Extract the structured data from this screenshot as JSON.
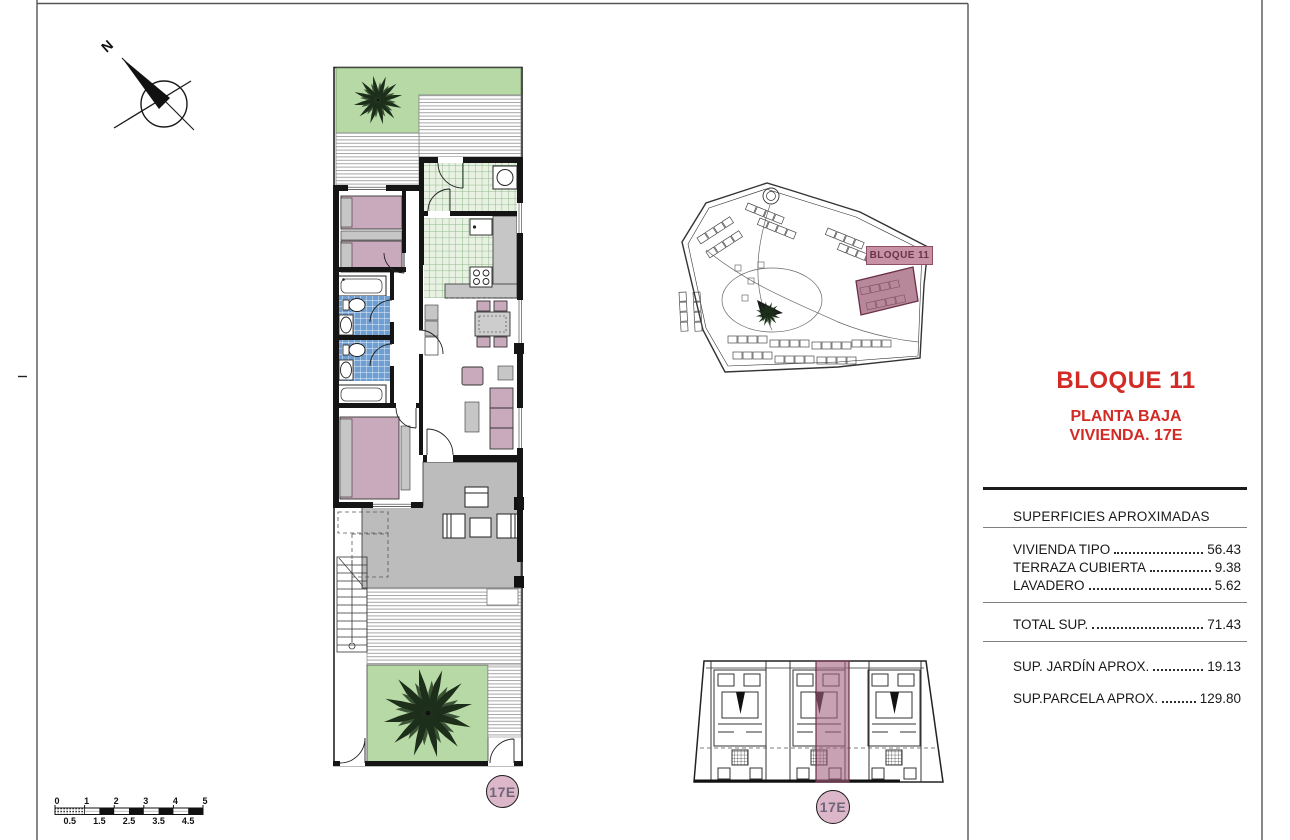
{
  "compass": {
    "label": "N"
  },
  "title_block": {
    "bloque": "BLOQUE 11",
    "planta": "PLANTA BAJA",
    "vivienda": "VIVIENDA. 17E"
  },
  "areas_table": {
    "header": "SUPERFICIES APROXIMADAS",
    "rows": [
      {
        "label": "VIVIENDA TIPO",
        "value": "56.43"
      },
      {
        "label": "TERRAZA CUBIERTA",
        "value": "9.38"
      },
      {
        "label": "LAVADERO",
        "value": "5.62"
      }
    ],
    "total": {
      "label": "TOTAL SUP.",
      "value": "71.43"
    },
    "extras": [
      {
        "label": "SUP. JARDÍN APROX.",
        "value": "19.13"
      },
      {
        "label": "SUP.PARCELA APROX.",
        "value": "129.80"
      }
    ]
  },
  "site_plan": {
    "highlight_label": "BLOQUE 11"
  },
  "badges": {
    "floor_plan": "17E",
    "block_plan": "17E"
  },
  "scale_bar": {
    "top_labels": [
      "0",
      "1",
      "2",
      "3",
      "4",
      "5"
    ],
    "bottom_labels": [
      "0.5",
      "1.5",
      "2.5",
      "3.5",
      "4.5"
    ]
  },
  "colors": {
    "accent_red": "#d22b26",
    "highlight_mauve": "#9b5a73",
    "badge_pink": "#dcb6c9",
    "garden_green": "#b7d9a6",
    "furniture_pink": "#c9a9bc",
    "tile_blue": "#6f9fd2",
    "tile_green_bg": "#e9f1e3",
    "terrace_gray": "#bcbcbc"
  }
}
